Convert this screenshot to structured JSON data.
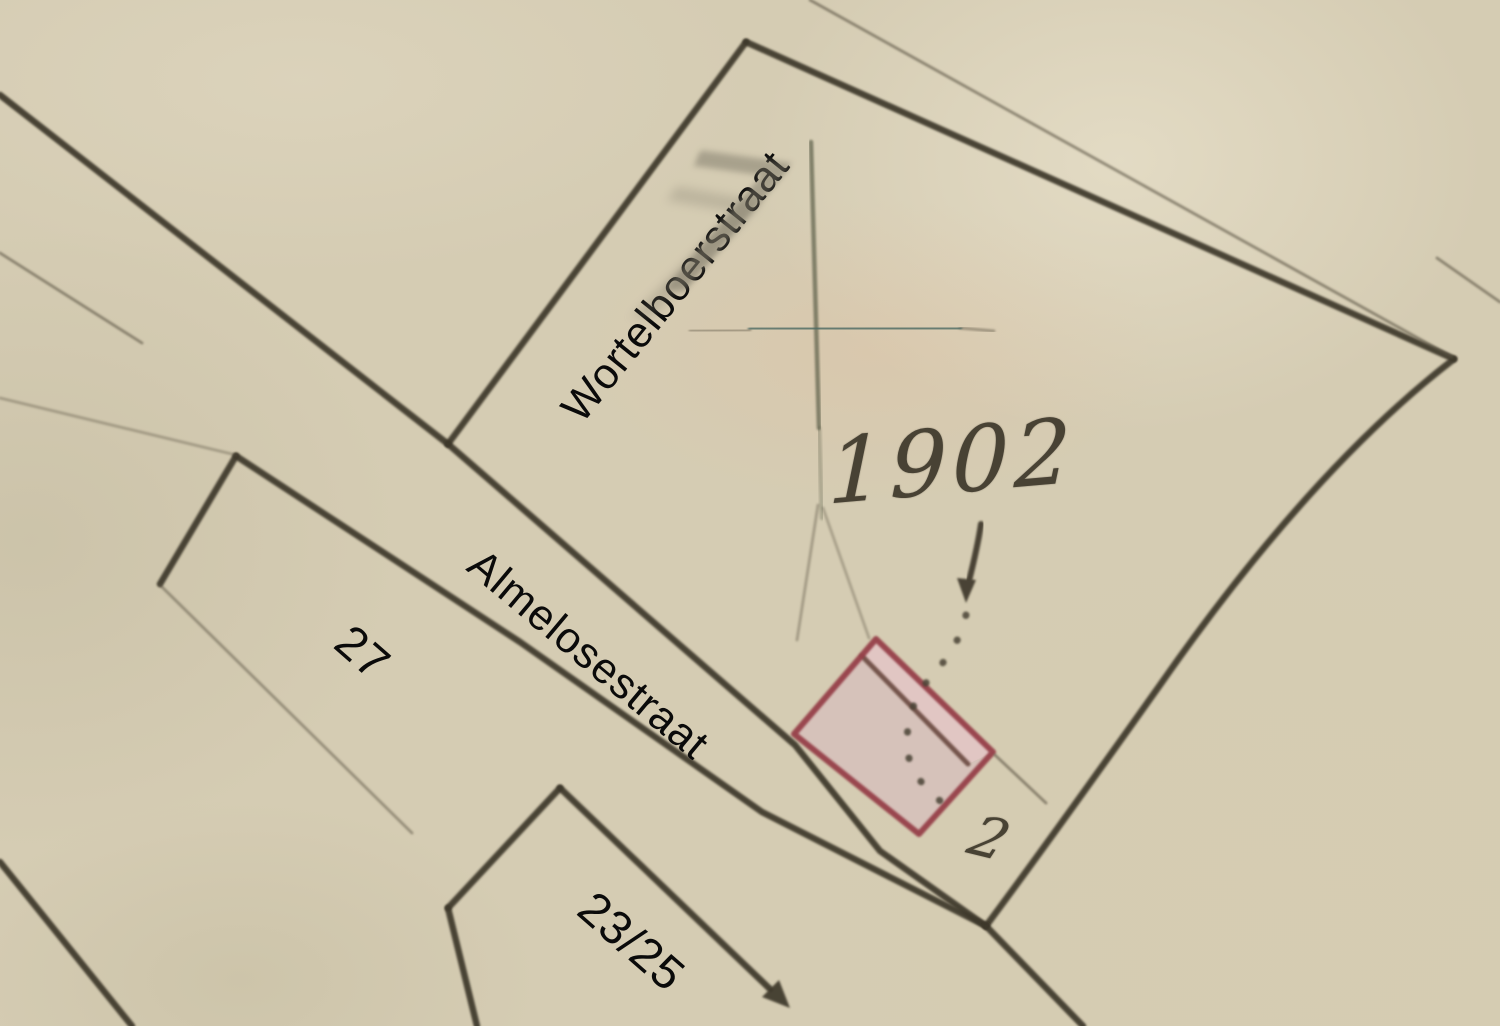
{
  "labels": {
    "street_1": "Wortelboerstraat",
    "street_2": "Almelosestraat",
    "house_number_1": "27",
    "house_number_2": "23/25"
  },
  "annotations": {
    "year_number": "1902",
    "parcel_number": "2",
    "pencil_mark": "7"
  },
  "colors": {
    "paper": "#d5ccb3",
    "map_ink": "#3e382c",
    "map_ink_thin": "#56503f",
    "grid_teal": "#4d6b64",
    "grid_olive": "#5c5e49",
    "handwriting_ink": "#484234",
    "parcel_red": "#96404a",
    "parcel_fill": "#d6c1ba",
    "parcel_strip_fill": "#e2c6c3",
    "parcel_divider": "#6b4a40",
    "pencil_gray": "#7c7767",
    "label_black": "#0a0a0a"
  }
}
